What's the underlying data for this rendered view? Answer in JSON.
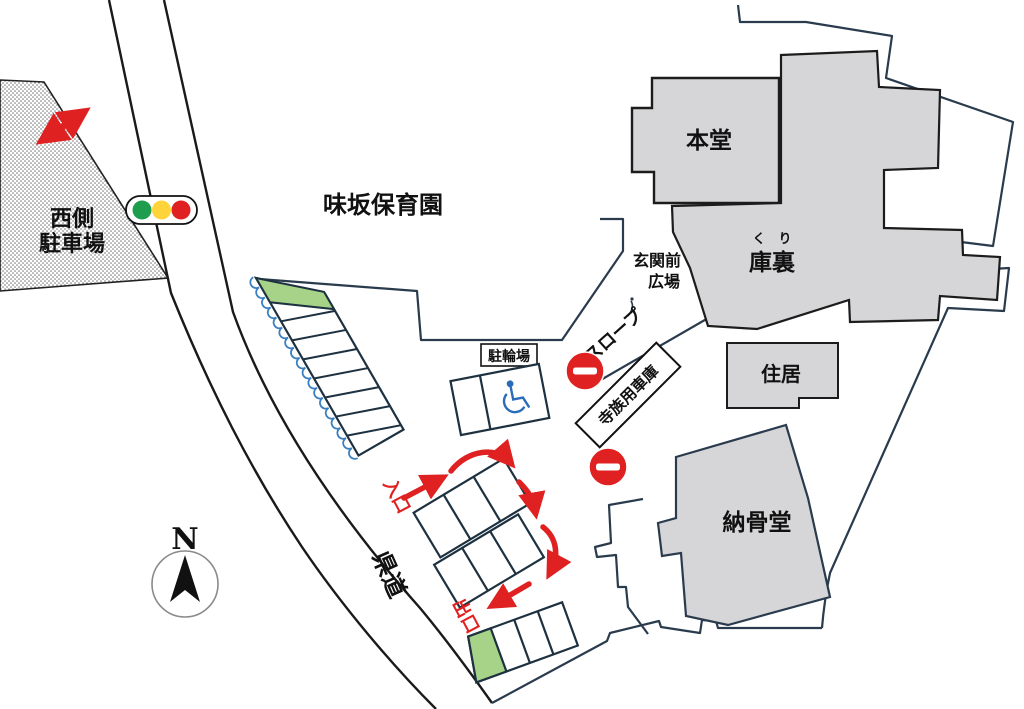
{
  "map": {
    "areas": {
      "west_parking": {
        "label_line1": "西側",
        "label_line2": "駐車場"
      },
      "nursery_school": {
        "label": "味坂保育園"
      },
      "entrance_plaza": {
        "label_line1": "玄関前",
        "label_line2": "広場"
      },
      "slope": {
        "label": "スロープ"
      },
      "bicycle_parking": {
        "label": "駐輪場"
      },
      "prefectural_road": {
        "label": "県道"
      }
    },
    "buildings": {
      "main_hall": {
        "label": "本堂"
      },
      "priests_quarters": {
        "label": "庫裏",
        "furigana": "く　り"
      },
      "family_garage": {
        "label": "寺族用車庫"
      },
      "residence": {
        "label": "住居"
      },
      "ossuary": {
        "label": "納骨堂"
      }
    },
    "traffic_flow": {
      "entrance_label": "入口",
      "exit_label": "出口"
    },
    "compass": {
      "north_label": "N"
    },
    "icons": {
      "traffic_light": "traffic-light-icon",
      "no_entry": "no-entry-icon",
      "wheelchair": "wheelchair-icon",
      "north_arrow": "north-arrow-icon"
    },
    "colors": {
      "building_fill": "#d6d6d8",
      "building_outline": "#1c1c1c",
      "site_boundary": "#2a3b4d",
      "road_line": "#1a1a1a",
      "accent_red": "#e02121",
      "green_stall": "#a6d388",
      "scallop_blue": "#3a7fc1",
      "wheelchair_blue": "#2b6cb8",
      "signal_green": "#1f9d4f",
      "signal_yellow": "#ffd43b",
      "signal_red": "#e02121"
    }
  }
}
